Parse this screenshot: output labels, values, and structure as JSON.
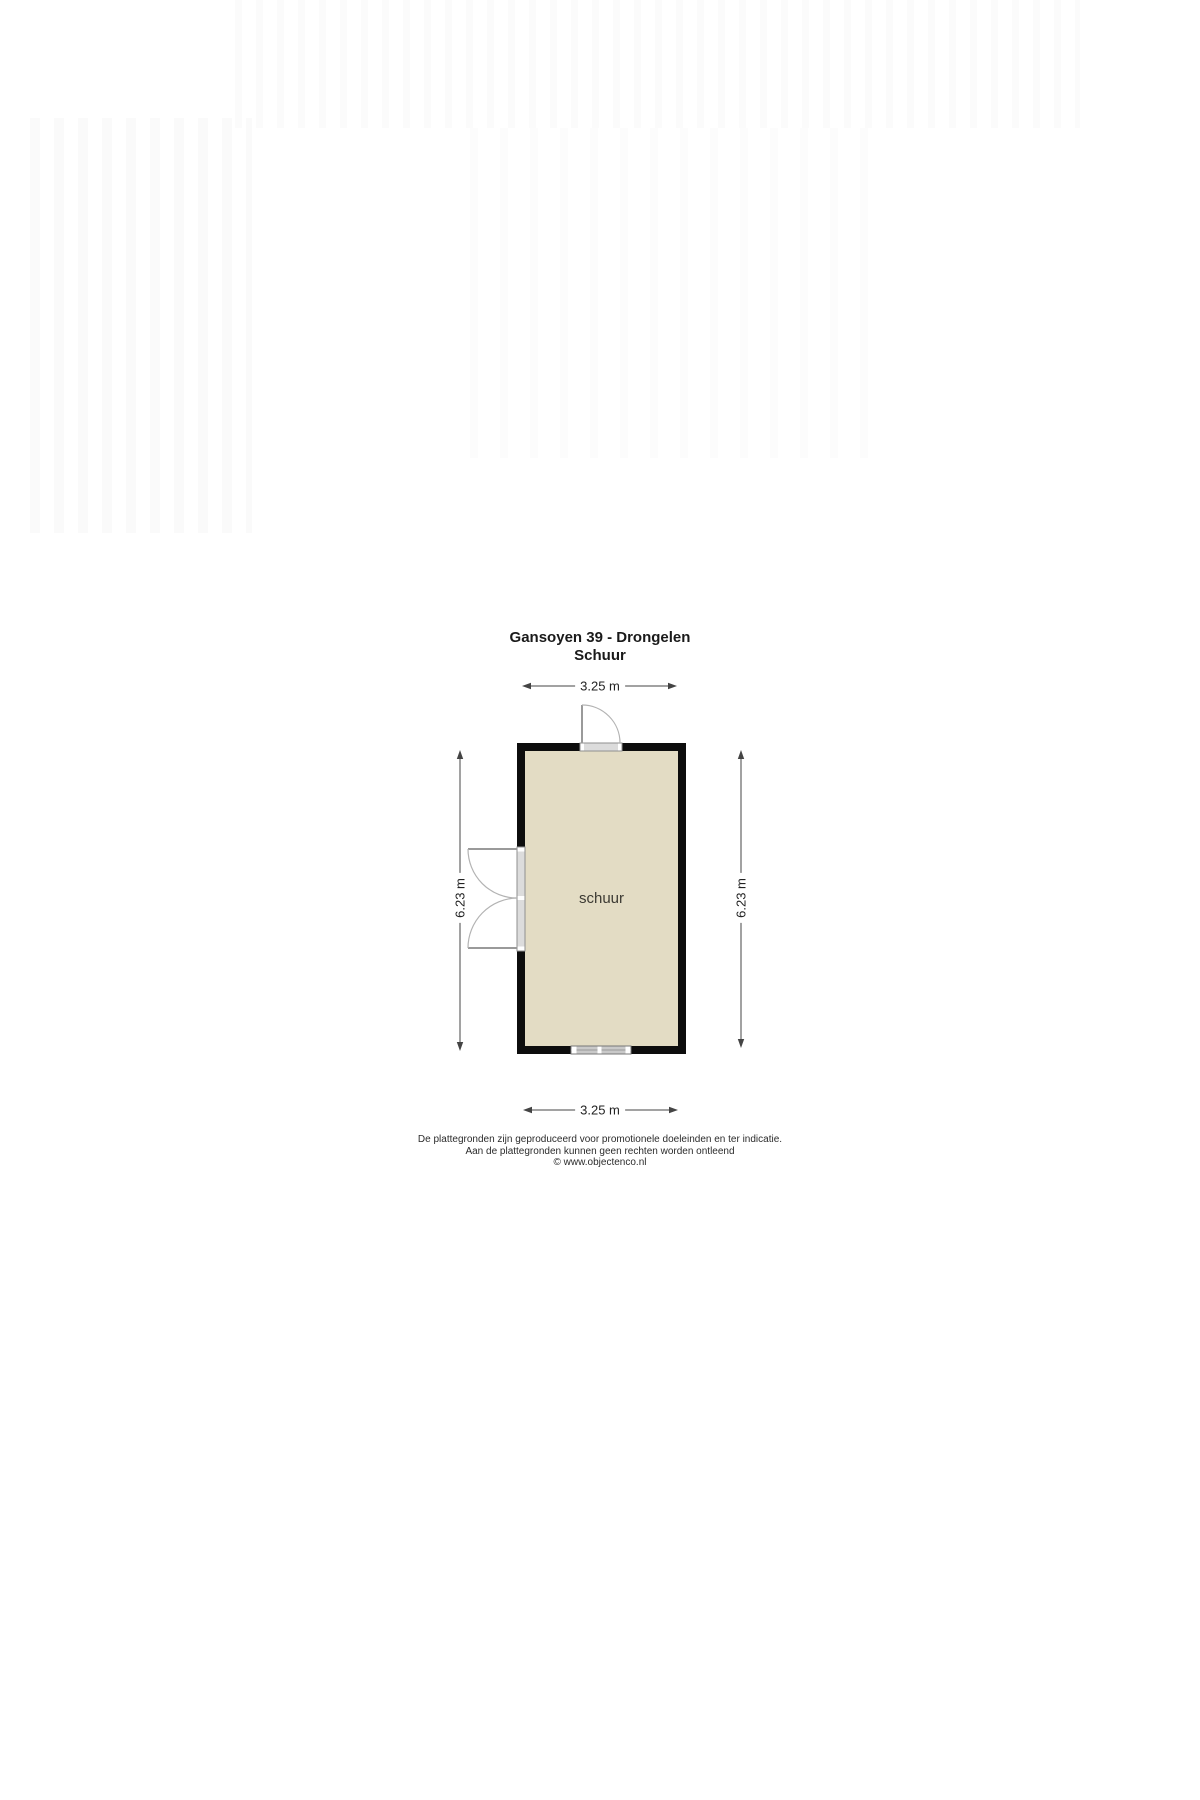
{
  "title": {
    "line1": "Gansoyen 39 - Drongelen",
    "line2": "Schuur"
  },
  "plan": {
    "room_label": "schuur",
    "dim_top": "3.25 m",
    "dim_bottom": "3.25 m",
    "dim_left": "6.23 m",
    "dim_right": "6.23 m",
    "colors": {
      "wall": "#0d0d0d",
      "floor": "#e3dcc4",
      "dimension_line": "#444444",
      "door_line": "#9a9a9a"
    }
  },
  "footer": {
    "line1": "De plattegronden zijn geproduceerd voor promotionele doeleinden en ter indicatie.",
    "line2": "Aan de plattegronden kunnen geen rechten worden ontleend",
    "line3": "© www.objectenco.nl"
  }
}
